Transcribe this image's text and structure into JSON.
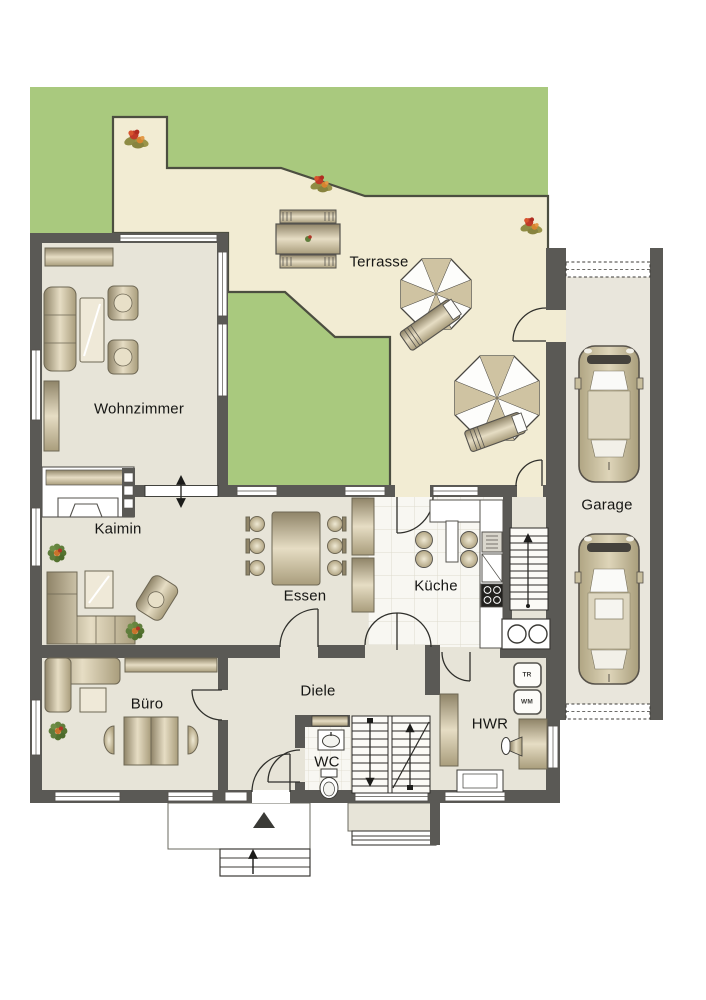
{
  "rooms": {
    "terrasse": "Terrasse",
    "wohnzimmer": "Wohnzimmer",
    "kamin": "Kaimin",
    "essen": "Essen",
    "kueche": "Küche",
    "garage": "Garage",
    "buero": "Büro",
    "diele": "Diele",
    "wc": "WC",
    "hwr": "HWR"
  },
  "appliances": {
    "tr": "TR",
    "wm": "WM"
  },
  "colors": {
    "garden": "#a9c97e",
    "garden_outline": "#4c4e40",
    "terrace": "#f2ecd3",
    "floor": "#e7e4d8",
    "garage_floor": "#e9e6dc",
    "tile": "#f8f7f2",
    "wall": "#5a5955",
    "door_line": "#2f2f2b",
    "furniture_edge": "#6e6754"
  }
}
